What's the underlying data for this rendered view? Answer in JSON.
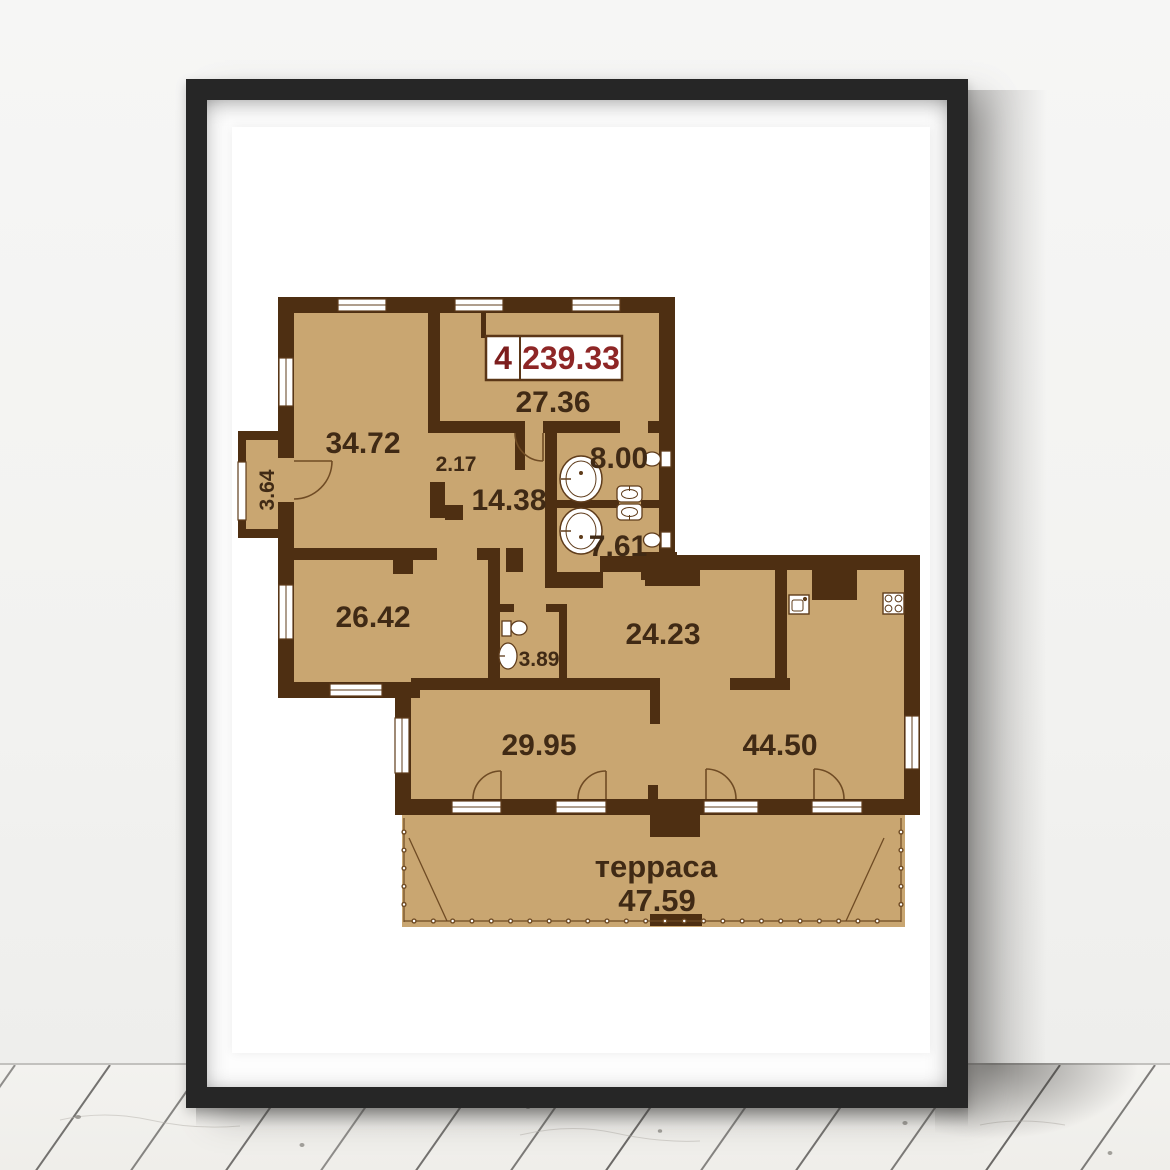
{
  "poster": {
    "badge": {
      "unit": "4",
      "total_area": "239.33"
    },
    "rooms": {
      "hall": "27.36",
      "living": "34.72",
      "balcony": "3.64",
      "closet": "2.17",
      "corridor": "14.38",
      "bath_top": "8.00",
      "bath_bottom": "7.61",
      "bedroom_left": "26.42",
      "wc": "3.89",
      "dining": "24.23",
      "bedroom_bottom": "29.95",
      "living_bottom": "44.50"
    },
    "terrace": {
      "name": "терраса",
      "area": "47.59"
    },
    "colors": {
      "room_fill": "#c9a671",
      "wall_brown": "#4e2f12",
      "outline_brown": "#5f3c1b",
      "label_brown": "#402a15",
      "badge_red": "#8e2626",
      "frame_black": "#262626"
    }
  }
}
